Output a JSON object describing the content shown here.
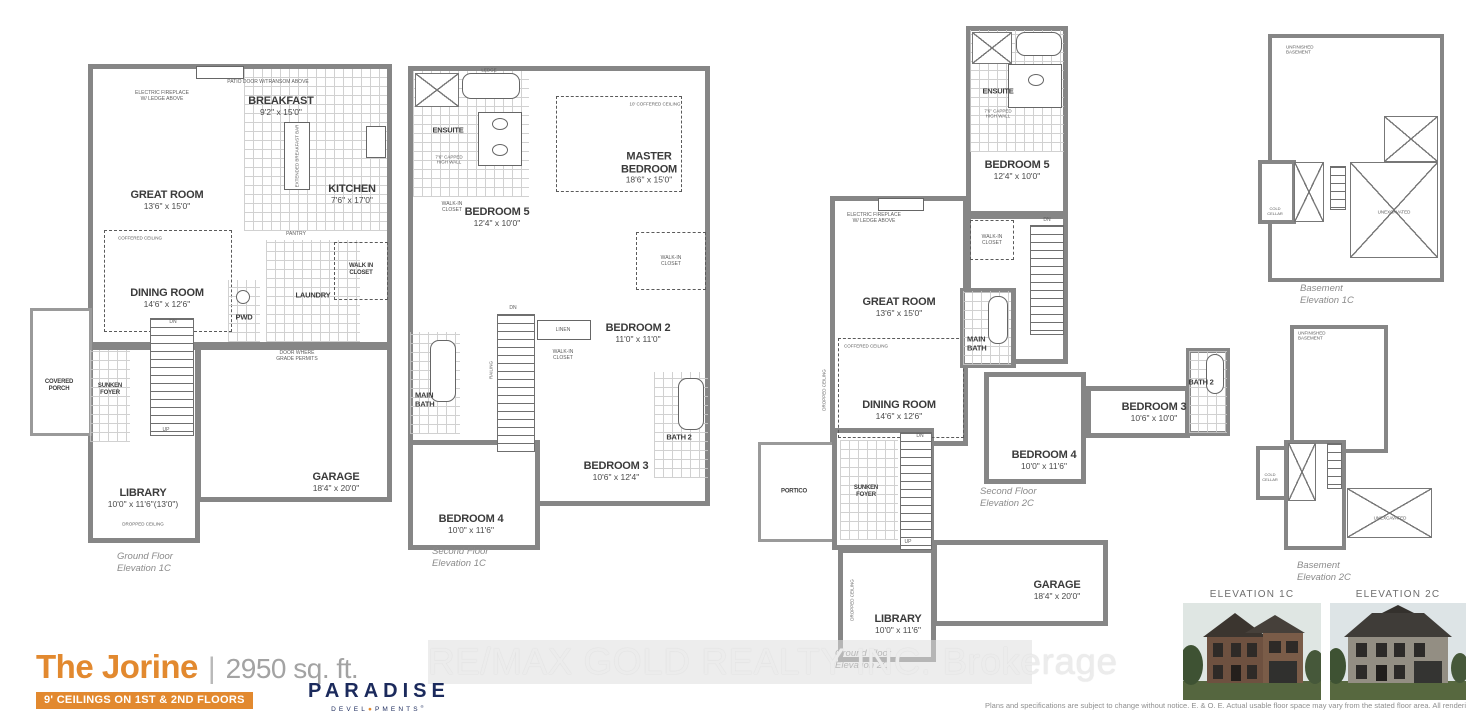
{
  "colors": {
    "accent_orange": "#e2892f",
    "brand_navy": "#1b2a5c",
    "wall_gray": "#868686"
  },
  "watermark": "RE/MAX GOLD REALTY INC. Brokerage",
  "disclaimer": "Plans and specifications are subject to change without notice. E. & O. E.  Actual usable floor space may vary from the stated floor area. All renderings are artist's concept. (411)",
  "title_block": {
    "name": "The Jorine",
    "separator": "|",
    "sqft": "2950 sq. ft.",
    "badge": "9' CEILINGS ON 1ST & 2ND FLOORS",
    "brand": "PARADISE",
    "brand_sub_left": "DEVEL",
    "brand_dot": "●",
    "brand_sub_right": "PMENTS",
    "brand_reg": "®"
  },
  "plans": {
    "ground_1c": {
      "caption": [
        "Ground Floor",
        "Elevation 1C"
      ],
      "rooms": {
        "great_room": {
          "name": "GREAT ROOM",
          "dims": "13'6\" x 15'0\""
        },
        "breakfast": {
          "name": "BREAKFAST",
          "dims": "9'2\" x 15'0\""
        },
        "kitchen": {
          "name": "KITCHEN",
          "dims": "7'6\" x 17'0\""
        },
        "dining": {
          "name": "DINING ROOM",
          "dims": "14'6\" x 12'6\""
        },
        "pwd": {
          "name": "PWD"
        },
        "laundry": {
          "name": "LAUNDRY"
        },
        "wic": {
          "name": "WALK IN CLOSET"
        },
        "covered_porch": {
          "name": "COVERED PORCH"
        },
        "sunken_foyer": {
          "name": "SUNKEN FOYER"
        },
        "library": {
          "name": "LIBRARY",
          "dims": "10'0\" x 11'6\"(13'0\")"
        },
        "garage": {
          "name": "GARAGE",
          "dims": "18'4\" x 20'0\""
        }
      },
      "notes": {
        "fireplace": "ELECTRIC FIREPLACE W/ LEDGE ABOVE",
        "patio": "PATIO DOOR W/TRANSOM ABOVE",
        "coffered": "COFFERED CEILING",
        "pantry": "PANTRY",
        "breakfast_bar": "EXTENDED BREAKFAST BAR",
        "door_grade": "DOOR WHERE GRADE PERMITS",
        "dropped": "DROPPED CEILING",
        "dn": "DN",
        "up": "UP"
      }
    },
    "second_1c": {
      "caption": [
        "Second Floor",
        "Elevation 1C"
      ],
      "rooms": {
        "ensuite": {
          "name": "ENSUITE"
        },
        "master": {
          "name": "MASTER BEDROOM",
          "dims": "18'6\" x 15'0\""
        },
        "bedroom5": {
          "name": "BEDROOM 5",
          "dims": "12'4\" x 10'0\""
        },
        "bedroom2": {
          "name": "BEDROOM 2",
          "dims": "11'0\" x 11'0\""
        },
        "main_bath": {
          "name": "MAIN BATH"
        },
        "bath2": {
          "name": "BATH 2"
        },
        "bedroom3": {
          "name": "BEDROOM 3",
          "dims": "10'6\" x 12'4\""
        },
        "bedroom4": {
          "name": "BEDROOM 4",
          "dims": "10'0\" x 11'6\""
        },
        "linen": {
          "name": "LINEN"
        },
        "wic": {
          "name": "WALK-IN CLOSET"
        }
      },
      "notes": {
        "ledge": "LEDGE",
        "capped": "7'6\" CAPPED HIGH WALL",
        "coffered10": "10' COFFERED CEILING",
        "railing": "RAILING",
        "dn": "DN"
      }
    },
    "ground_2c": {
      "caption": [
        "Ground Floor",
        "Elevation 2C"
      ],
      "rooms": {
        "great_room": {
          "name": "GREAT ROOM",
          "dims": "13'6\" x 15'0\""
        },
        "dining": {
          "name": "DINING ROOM",
          "dims": "14'6\" x 12'6\""
        },
        "portico": {
          "name": "PORTICO"
        },
        "sunken_foyer": {
          "name": "SUNKEN FOYER"
        },
        "library": {
          "name": "LIBRARY",
          "dims": "10'0\" x 11'6\""
        },
        "garage": {
          "name": "GARAGE",
          "dims": "18'4\" x 20'0\""
        }
      },
      "notes": {
        "fireplace": "ELECTRIC FIREPLACE W/ LEDGE ABOVE",
        "coffered": "COFFERED CEILING",
        "dropped": "DROPPED CEILING",
        "dn": "DN",
        "up": "UP"
      }
    },
    "second_2c": {
      "caption": [
        "Second Floor",
        "Elevation 2C"
      ],
      "rooms": {
        "ensuite": {
          "name": "ENSUITE"
        },
        "bedroom5": {
          "name": "BEDROOM 5",
          "dims": "12'4\" x 10'0\""
        },
        "main_bath": {
          "name": "MAIN BATH"
        },
        "bedroom4": {
          "name": "BEDROOM 4",
          "dims": "10'0\" x 11'6\""
        },
        "bedroom3": {
          "name": "BEDROOM 3",
          "dims": "10'6\" x 10'0\""
        },
        "bath2": {
          "name": "BATH 2"
        },
        "wic": {
          "name": "WALK-IN CLOSET"
        }
      },
      "notes": {
        "capped": "7'6\" CAPPED HIGH WALL",
        "dn": "DN"
      }
    }
  },
  "basements": {
    "b1c": {
      "caption": [
        "Basement",
        "Elevation 1C"
      ],
      "labels": {
        "unfinished": "UNFINISHED BASEMENT",
        "unexcavated": "UNEXCAVATED",
        "cold_cellar": "COLD CELLAR"
      }
    },
    "b2c": {
      "caption": [
        "Basement",
        "Elevation 2C"
      ],
      "labels": {
        "unfinished": "UNFINISHED BASEMENT",
        "unexcavated": "UNEXCAVATED",
        "cold_cellar": "COLD CELLAR"
      }
    }
  },
  "elevations": {
    "e1c": {
      "label": "ELEVATION 1C"
    },
    "e2c": {
      "label": "ELEVATION 2C"
    }
  }
}
